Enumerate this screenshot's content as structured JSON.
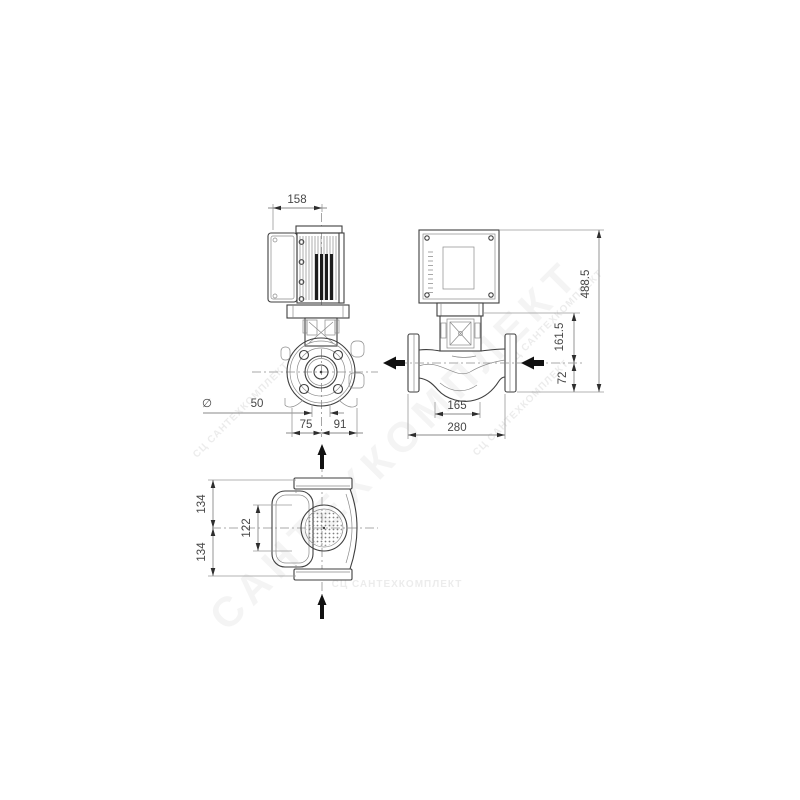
{
  "drawing": {
    "type": "pump-dimensional-drawing",
    "views": {
      "front": {
        "dims": {
          "motor_width": "158",
          "diameter_symbol": "∅",
          "port_diameter": "50",
          "left_of_axis": "75",
          "right_of_axis": "91"
        }
      },
      "side": {
        "dims": {
          "volute_width": "165",
          "overall_length": "280",
          "axis_to_base": "72",
          "axis_to_head": "161.5",
          "overall_height": "488.5"
        }
      },
      "top": {
        "dims": {
          "upper_half": "134",
          "lower_half": "134",
          "body_width": "122"
        }
      }
    },
    "colors": {
      "part_line": "#3f3f3f",
      "dim_line": "#8a8a8a",
      "dim_text": "#474747",
      "arrowhead": "#2e2e2e",
      "flow_arrow": "#111111",
      "background": "#ffffff"
    }
  },
  "watermarks": {
    "large_diagonal": "САНТЕХКОМПЛЕКТ",
    "small": "СЦ САНТЕХКОМПЛЕКТ"
  }
}
